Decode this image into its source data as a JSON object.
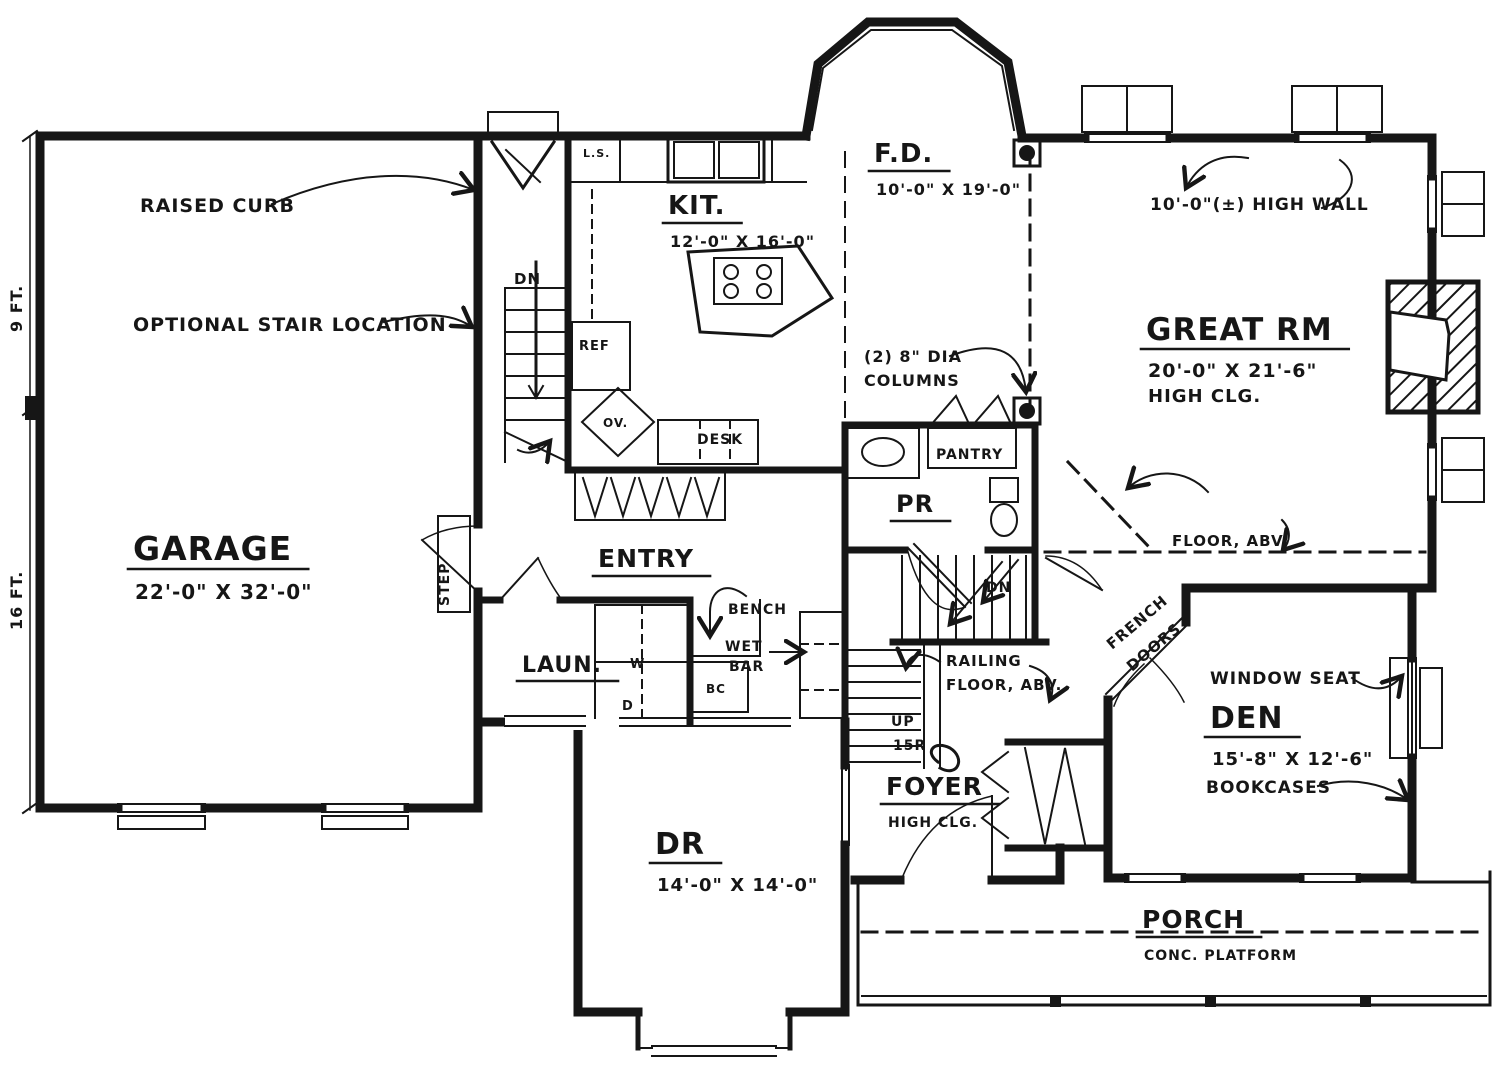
{
  "plan": {
    "colors": {
      "ink": "#161616",
      "paper": "#ffffff"
    },
    "rooms": [
      {
        "name": "GARAGE",
        "dims": "22'-0\" X 32'-0\"",
        "x": 133,
        "y": 560,
        "size": 33
      },
      {
        "name": "KIT.",
        "dims": "12'-0\" X 16'-0\"",
        "x": 668,
        "y": 214,
        "size": 26
      },
      {
        "name": "F.D.",
        "dims": "10'-0\" X 19'-0\"",
        "x": 874,
        "y": 162,
        "size": 26
      },
      {
        "name": "GREAT RM",
        "dims": "20'-0\" X 21'-6\"",
        "note": "HIGH CLG.",
        "x": 1146,
        "y": 340,
        "size": 31
      },
      {
        "name": "ENTRY",
        "x": 598,
        "y": 567,
        "size": 25
      },
      {
        "name": "LAUN.",
        "x": 522,
        "y": 672,
        "size": 22
      },
      {
        "name": "PR",
        "x": 896,
        "y": 512,
        "size": 24
      },
      {
        "name": "FOYER",
        "note": "HIGH CLG.",
        "x": 886,
        "y": 795,
        "size": 25
      },
      {
        "name": "DR",
        "dims": "14'-0\" X 14'-0\"",
        "x": 655,
        "y": 854,
        "size": 30
      },
      {
        "name": "DEN",
        "dims": "15'-8\" X 12'-6\"",
        "x": 1210,
        "y": 728,
        "size": 30
      },
      {
        "name": "PORCH",
        "note": "CONC. PLATFORM",
        "x": 1142,
        "y": 928,
        "size": 25
      }
    ],
    "annotations": [
      {
        "text": "RAISED CURB",
        "x": 140,
        "y": 212,
        "size": 19,
        "name": "raised-curb-note"
      },
      {
        "text": "OPTIONAL STAIR LOCATION",
        "x": 133,
        "y": 331,
        "size": 19,
        "name": "optional-stair-note"
      },
      {
        "text": "(2) 8\" DIA",
        "x": 864,
        "y": 362,
        "size": 16,
        "name": "columns-note-line1"
      },
      {
        "text": "COLUMNS",
        "x": 864,
        "y": 386,
        "size": 16,
        "name": "columns-note-line2"
      },
      {
        "text": "10'-0\"(±) HIGH WALL",
        "x": 1150,
        "y": 210,
        "size": 17,
        "name": "high-wall-note"
      },
      {
        "text": "FLOOR, ABV.",
        "x": 1172,
        "y": 546,
        "size": 15,
        "name": "floor-above-note"
      },
      {
        "text": "RAILING",
        "x": 946,
        "y": 666,
        "size": 15,
        "name": "railing-note-line1"
      },
      {
        "text": "FLOOR, ABV.",
        "x": 946,
        "y": 690,
        "size": 15,
        "name": "railing-note-line2"
      },
      {
        "text": "FRENCH",
        "x": 1112,
        "y": 650,
        "size": 15,
        "rotate": -40,
        "name": "french-doors-note-line1"
      },
      {
        "text": "DOORS",
        "x": 1132,
        "y": 672,
        "size": 15,
        "rotate": -40,
        "name": "french-doors-note-line2"
      },
      {
        "text": "WINDOW SEAT",
        "x": 1210,
        "y": 684,
        "size": 17,
        "name": "window-seat-note"
      },
      {
        "text": "BOOKCASES",
        "x": 1206,
        "y": 793,
        "size": 17,
        "name": "bookcases-note"
      },
      {
        "text": "BENCH",
        "x": 728,
        "y": 614,
        "size": 14,
        "name": "bench-note"
      },
      {
        "text": "WET",
        "x": 725,
        "y": 651,
        "size": 14,
        "name": "wet-bar-note-line1"
      },
      {
        "text": "BAR",
        "x": 729,
        "y": 671,
        "size": 14,
        "name": "wet-bar-note-line2"
      },
      {
        "text": "STEP",
        "x": 449,
        "y": 606,
        "size": 14,
        "rotate": -90,
        "name": "step-note"
      },
      {
        "text": "9 FT.",
        "x": 22,
        "y": 332,
        "size": 16,
        "rotate": -90,
        "name": "dim-9ft"
      },
      {
        "text": "16 FT.",
        "x": 22,
        "y": 630,
        "size": 16,
        "rotate": -90,
        "name": "dim-16ft"
      },
      {
        "text": "DN",
        "x": 514,
        "y": 284,
        "size": 15,
        "name": "stair-dn-label"
      },
      {
        "text": "DN",
        "x": 986,
        "y": 592,
        "size": 14,
        "name": "backstair-dn-label"
      },
      {
        "text": "UP",
        "x": 891,
        "y": 726,
        "size": 14,
        "name": "stair-up-label"
      },
      {
        "text": "15R",
        "x": 893,
        "y": 750,
        "size": 14,
        "name": "stair-risers-label"
      },
      {
        "text": "REF",
        "x": 579,
        "y": 350,
        "size": 13,
        "name": "ref-label"
      },
      {
        "text": "OV.",
        "x": 603,
        "y": 427,
        "size": 12,
        "name": "oven-label"
      },
      {
        "text": "DESK",
        "x": 697,
        "y": 444,
        "size": 14,
        "name": "desk-label"
      },
      {
        "text": "L.S.",
        "x": 583,
        "y": 157,
        "size": 11,
        "name": "ls-label"
      },
      {
        "text": "W",
        "x": 630,
        "y": 668,
        "size": 13,
        "name": "washer-label"
      },
      {
        "text": "D",
        "x": 622,
        "y": 710,
        "size": 13,
        "name": "dryer-label"
      },
      {
        "text": "BC",
        "x": 706,
        "y": 693,
        "size": 12,
        "name": "bc-label"
      },
      {
        "text": "PANTRY",
        "x": 936,
        "y": 459,
        "size": 14,
        "name": "pantry-label"
      }
    ]
  }
}
